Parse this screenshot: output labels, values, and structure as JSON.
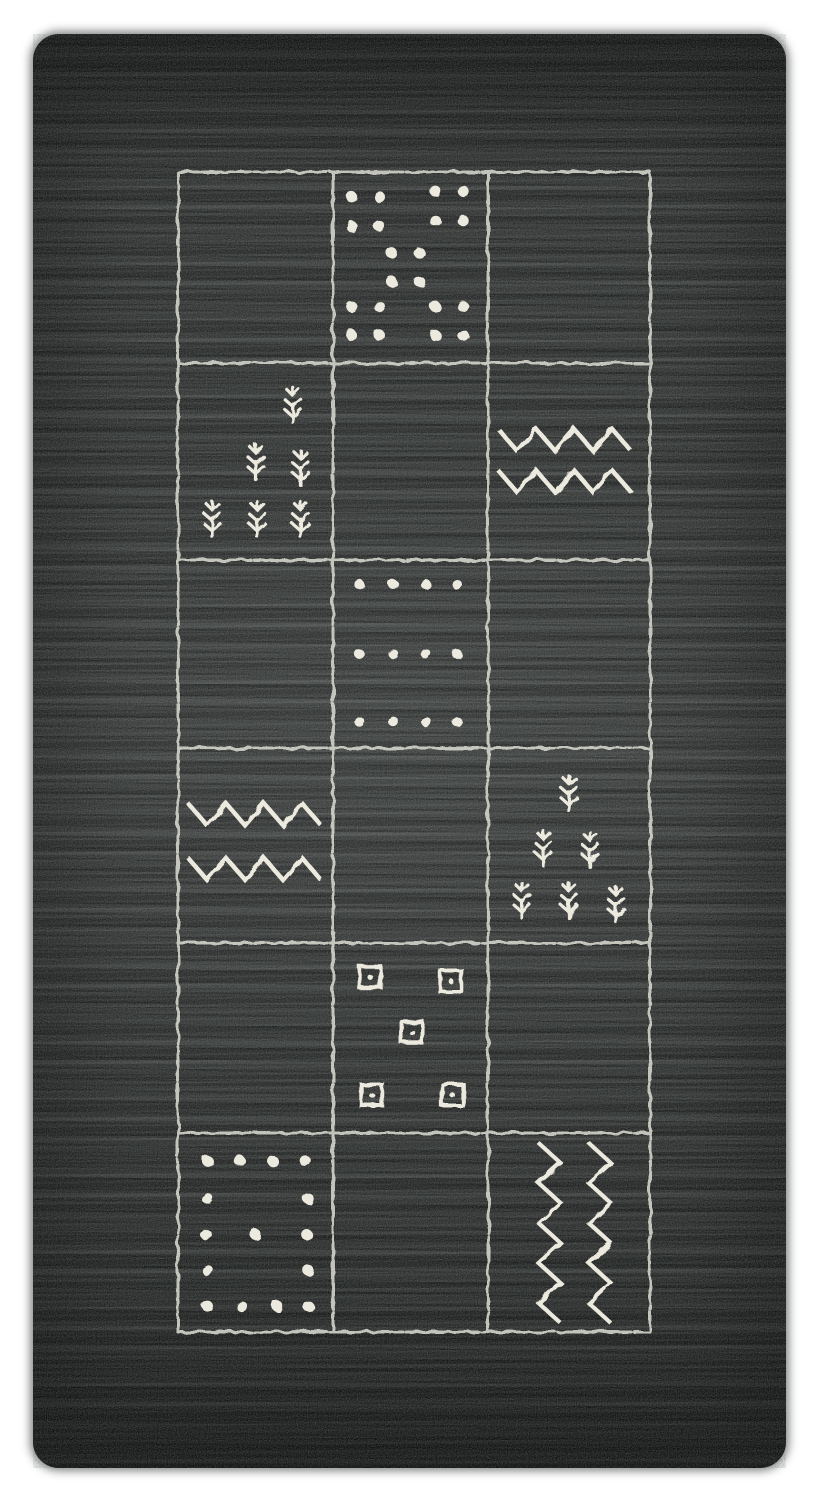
{
  "scene": {
    "description": "Top-down photograph of a dark charcoal hand-woven wool rug on a white background. An ivory hand-drawn grid of 3 columns by 6 rows is woven into the field; some panels hold tribal motifs: dot clusters, rows of dots, plant sprigs, horizontal zigzag bands, outlined squares with center dots, a dotted border panel and vertical zigzag lines.",
    "background_color": "#ffffff"
  },
  "palette": {
    "rug_base": "#2b2e2d",
    "rug_shadow": "#161817",
    "stria_light": "#5e625f",
    "grid_line": "#d7d8ce",
    "motif_color": "#ece9de"
  },
  "rug": {
    "left": 33,
    "top": 34,
    "width": 753,
    "height": 1434,
    "corner_radius": 26
  },
  "grid": {
    "left": 145,
    "top": 138,
    "col_edges": [
      0,
      155,
      310,
      472
    ],
    "row_edges": [
      0,
      191,
      388,
      576,
      771,
      961,
      1160
    ],
    "line_width": 3
  },
  "cells": [
    {
      "row": 0,
      "col": 0,
      "name": "empty-panel",
      "motif": "empty"
    },
    {
      "row": 0,
      "col": 1,
      "name": "dot-cluster-panel",
      "motif": "dots",
      "dot_r": 5.5,
      "items": [
        [
          0.12,
          0.13
        ],
        [
          0.3,
          0.13
        ],
        [
          0.12,
          0.285
        ],
        [
          0.3,
          0.285
        ],
        [
          0.66,
          0.1
        ],
        [
          0.84,
          0.1
        ],
        [
          0.66,
          0.255
        ],
        [
          0.84,
          0.255
        ],
        [
          0.38,
          0.425
        ],
        [
          0.56,
          0.425
        ],
        [
          0.38,
          0.575
        ],
        [
          0.56,
          0.575
        ],
        [
          0.12,
          0.705
        ],
        [
          0.3,
          0.705
        ],
        [
          0.12,
          0.855
        ],
        [
          0.3,
          0.855
        ],
        [
          0.66,
          0.705
        ],
        [
          0.84,
          0.705
        ],
        [
          0.66,
          0.855
        ],
        [
          0.84,
          0.855
        ]
      ]
    },
    {
      "row": 0,
      "col": 2,
      "name": "empty-panel",
      "motif": "empty"
    },
    {
      "row": 1,
      "col": 0,
      "name": "plant-sprig-panel",
      "motif": "plants",
      "items": [
        [
          0.74,
          0.21
        ],
        [
          0.5,
          0.5
        ],
        [
          0.79,
          0.53
        ],
        [
          0.22,
          0.79
        ],
        [
          0.51,
          0.79
        ],
        [
          0.79,
          0.79
        ]
      ]
    },
    {
      "row": 1,
      "col": 1,
      "name": "empty-panel",
      "motif": "empty"
    },
    {
      "row": 1,
      "col": 2,
      "name": "zigzag-panel",
      "motif": "zigzag-h",
      "items": [
        0.39,
        0.6
      ]
    },
    {
      "row": 2,
      "col": 0,
      "name": "empty-panel",
      "motif": "empty"
    },
    {
      "row": 2,
      "col": 1,
      "name": "dot-rows-panel",
      "motif": "dots",
      "dot_r": 5,
      "items": [
        [
          0.17,
          0.13
        ],
        [
          0.39,
          0.13
        ],
        [
          0.6,
          0.13
        ],
        [
          0.8,
          0.13
        ],
        [
          0.17,
          0.5
        ],
        [
          0.39,
          0.5
        ],
        [
          0.6,
          0.5
        ],
        [
          0.8,
          0.5
        ],
        [
          0.17,
          0.86
        ],
        [
          0.39,
          0.86
        ],
        [
          0.6,
          0.86
        ],
        [
          0.8,
          0.86
        ]
      ]
    },
    {
      "row": 2,
      "col": 2,
      "name": "empty-panel",
      "motif": "empty"
    },
    {
      "row": 3,
      "col": 0,
      "name": "zigzag-panel",
      "motif": "zigzag-h",
      "items": [
        0.34,
        0.62
      ]
    },
    {
      "row": 3,
      "col": 1,
      "name": "empty-panel",
      "motif": "empty"
    },
    {
      "row": 3,
      "col": 2,
      "name": "plant-sprig-panel",
      "motif": "plants",
      "items": [
        [
          0.5,
          0.23
        ],
        [
          0.34,
          0.51
        ],
        [
          0.63,
          0.52
        ],
        [
          0.21,
          0.78
        ],
        [
          0.5,
          0.78
        ],
        [
          0.79,
          0.8
        ]
      ]
    },
    {
      "row": 4,
      "col": 0,
      "name": "empty-panel",
      "motif": "empty"
    },
    {
      "row": 4,
      "col": 1,
      "name": "square-dot-panel",
      "motif": "squares",
      "items": [
        [
          0.24,
          0.18
        ],
        [
          0.76,
          0.2
        ],
        [
          0.51,
          0.47
        ],
        [
          0.25,
          0.8
        ],
        [
          0.77,
          0.8
        ]
      ]
    },
    {
      "row": 4,
      "col": 2,
      "name": "empty-panel",
      "motif": "empty"
    },
    {
      "row": 5,
      "col": 0,
      "name": "dot-border-panel",
      "motif": "dots",
      "dot_r": 5.5,
      "items": [
        [
          0.19,
          0.14
        ],
        [
          0.4,
          0.14
        ],
        [
          0.61,
          0.14
        ],
        [
          0.82,
          0.14
        ],
        [
          0.19,
          0.33
        ],
        [
          0.84,
          0.33
        ],
        [
          0.18,
          0.51
        ],
        [
          0.5,
          0.51
        ],
        [
          0.83,
          0.51
        ],
        [
          0.19,
          0.69
        ],
        [
          0.84,
          0.69
        ],
        [
          0.19,
          0.87
        ],
        [
          0.41,
          0.87
        ],
        [
          0.64,
          0.87
        ],
        [
          0.84,
          0.87
        ]
      ]
    },
    {
      "row": 5,
      "col": 1,
      "name": "empty-panel",
      "motif": "empty"
    },
    {
      "row": 5,
      "col": 2,
      "name": "vertical-zigzag-panel",
      "motif": "zigzag-v",
      "items": [
        0.38,
        0.69
      ]
    }
  ]
}
